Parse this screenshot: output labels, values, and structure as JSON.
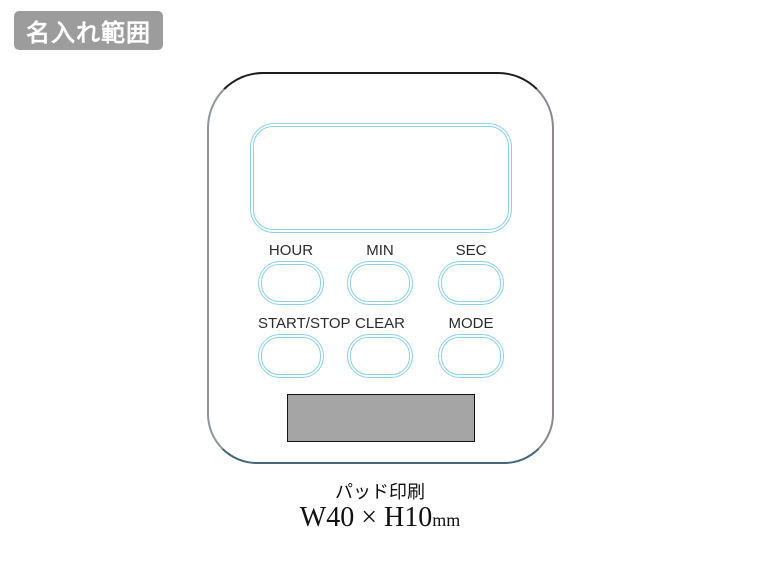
{
  "badge": {
    "label": "名入れ範囲",
    "bg_color": "#9c9c9c",
    "text_color": "#ffffff"
  },
  "device": {
    "type": "digital-timer-illustration",
    "outline_accent_color": "#8ecfe6",
    "body_border_top_color": "#1b1d1f",
    "body_border_bottom_color": "#42687a",
    "buttons": [
      {
        "label": "HOUR"
      },
      {
        "label": "MIN"
      },
      {
        "label": "SEC"
      },
      {
        "label": "START/STOP"
      },
      {
        "label": "CLEAR"
      },
      {
        "label": "MODE"
      }
    ],
    "print_area": {
      "fill_color": "#a5a5a5",
      "border_color": "#141414"
    }
  },
  "caption": {
    "method": "パッド印刷",
    "size": "W40 × H10",
    "unit": "mm"
  }
}
